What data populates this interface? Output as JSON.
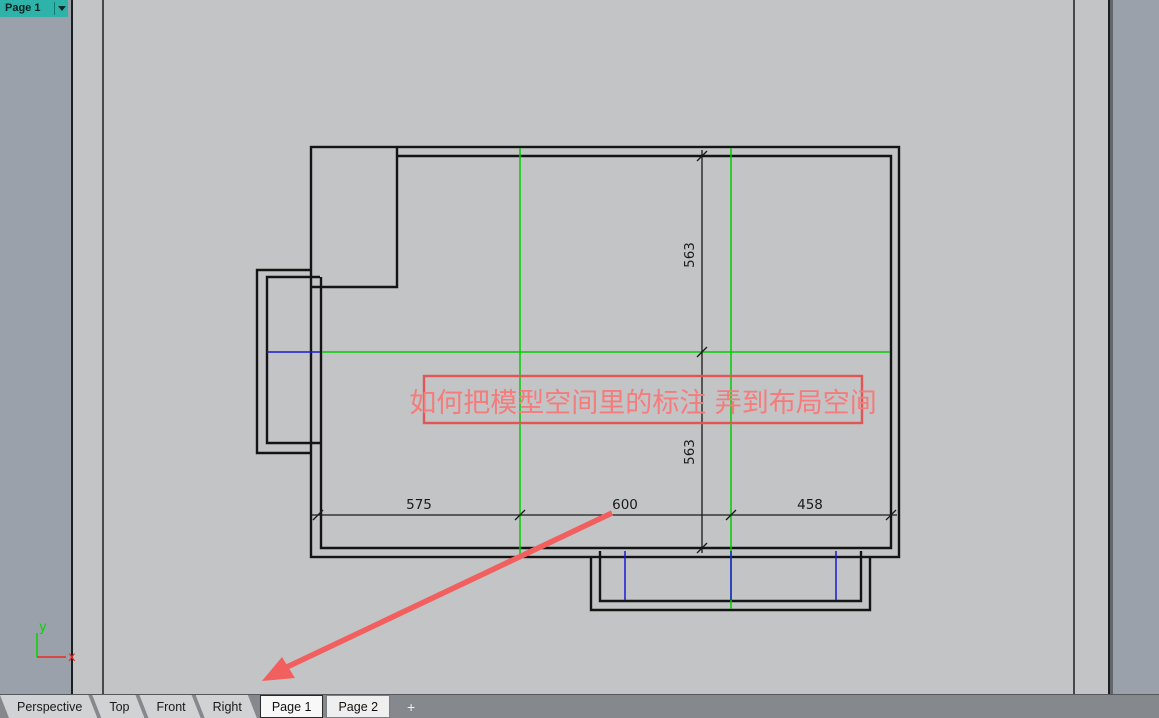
{
  "header": {
    "title": "Page 1"
  },
  "tabs": {
    "views": [
      {
        "label": "Perspective"
      },
      {
        "label": "Top"
      },
      {
        "label": "Front"
      },
      {
        "label": "Right"
      }
    ],
    "pages": [
      {
        "label": "Page 1",
        "active": true
      },
      {
        "label": "Page 2",
        "active": false
      }
    ],
    "add_label": "+"
  },
  "drawing": {
    "dim_horizontal": [
      {
        "label": "575"
      },
      {
        "label": "600"
      },
      {
        "label": "458"
      }
    ],
    "dim_vertical": [
      {
        "label": "563"
      },
      {
        "label": "563"
      }
    ],
    "annotation": {
      "text": "如何把模型空间里的标注 弄到布局空间"
    },
    "axis": {
      "x_label": "x",
      "y_label": "y"
    }
  },
  "colors": {
    "accent_teal": "#2eb3ab",
    "annotation_red": "#f06d6d",
    "arrow_red": "#f25f5f",
    "guide_green": "#00cd00",
    "guide_blue": "#1a1ad6",
    "axis_red": "#e92a23",
    "axis_green": "#00d800",
    "paper_gray": "#c3c4c5",
    "viewport_gray": "#9aa1aa"
  }
}
